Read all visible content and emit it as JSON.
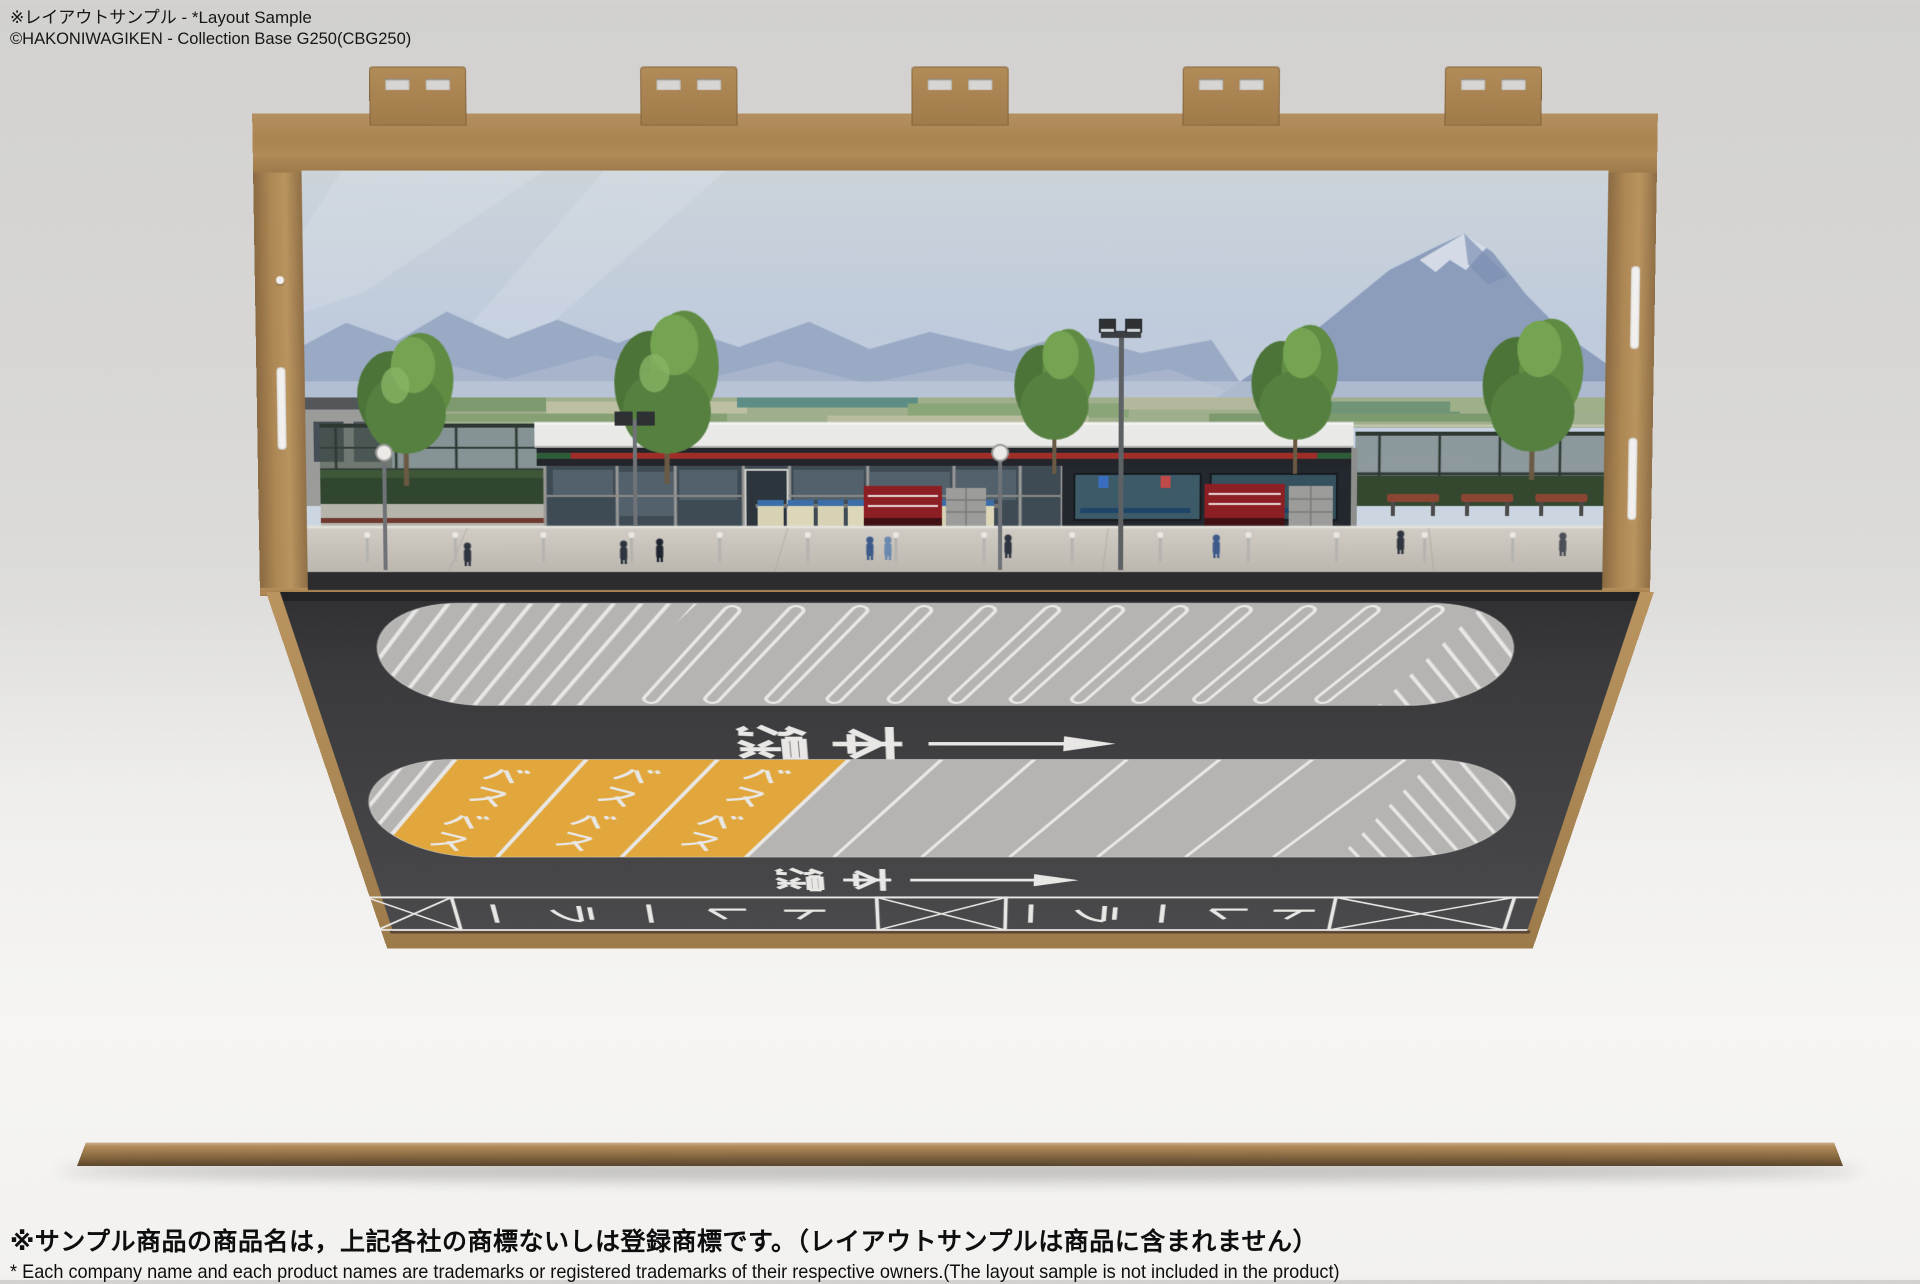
{
  "captions": {
    "top_line1": "※レイアウトサンプル - *Layout Sample",
    "top_line2": "©HAKONIWAGIKEN - Collection Base G250(CBG250)",
    "bottom_line1": "※サンプル商品の商品名は，上記各社の商標ないしは登録商標です。（レイアウトサンプルは商品に含まれません）",
    "bottom_line2": "* Each company name and each product names are trademarks or registered trademarks of their respective owners.(The layout sample is not included in the product)"
  },
  "road_markings": {
    "main_line_label": "本線",
    "main_line_display_chars": [
      "線",
      "本"
    ],
    "bus_label": "バス",
    "bus_display_chars": [
      "バ",
      "ス"
    ],
    "trailer_label": "トレーラー",
    "trailer_display_chars": [
      "ー",
      "ラ",
      "ー",
      "レ",
      "ト"
    ],
    "arrow_direction": "right"
  },
  "layout_counts": {
    "backdrop_tabs": 5,
    "upper_island_slots": 12,
    "lower_island_yellow_stalls": 3,
    "bus_labels_per_stall": 2,
    "lower_island_gray_dividers": 6,
    "trailer_boxes": 3,
    "trailer_texts": 2
  },
  "colors": {
    "bus_stall_yellow": "#e2a73c",
    "marking_white": "#e8e7e5",
    "asphalt_dark": "#3a3a3c",
    "island_pavement": "#b5b4b2",
    "mdf_wood": "#ab8656"
  }
}
